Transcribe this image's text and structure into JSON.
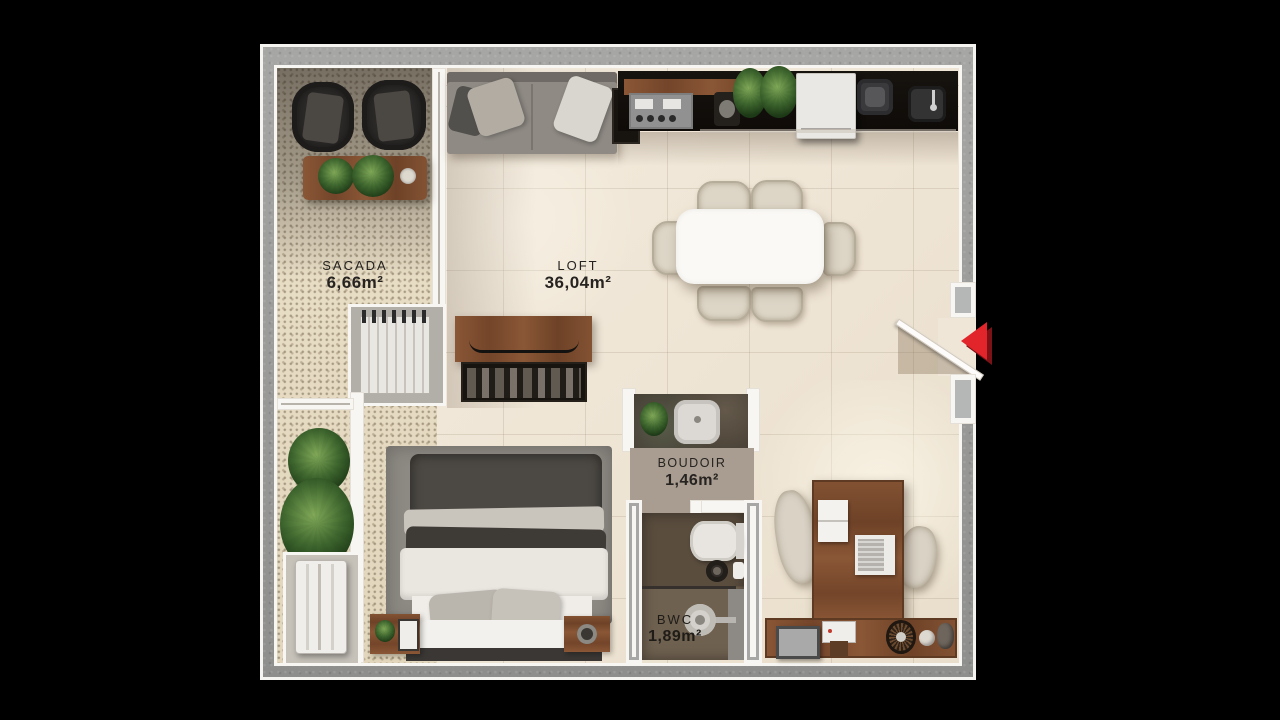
{
  "plan_type": "apartment-floor-plan",
  "rooms": {
    "sacada": {
      "name": "SACADA",
      "area": "6,66m²"
    },
    "loft": {
      "name": "LOFT",
      "area": "36,04m²"
    },
    "boudoir": {
      "name": "BOUDOIR",
      "area": "1,46m²"
    },
    "bwc": {
      "name": "BWC",
      "area": "1,89m²"
    }
  },
  "entrance": {
    "marker": "left-pointing-triangle",
    "color": "#e2242b"
  },
  "palette": {
    "background": "#000000",
    "interior_floor": "#f0e7d8",
    "balcony_floor": "#e7dcc3",
    "exterior_wall_concrete": "#9b9b99",
    "wall_white": "#f8f6f2",
    "wood": "#7f5233",
    "accent_red": "#e2242b"
  }
}
